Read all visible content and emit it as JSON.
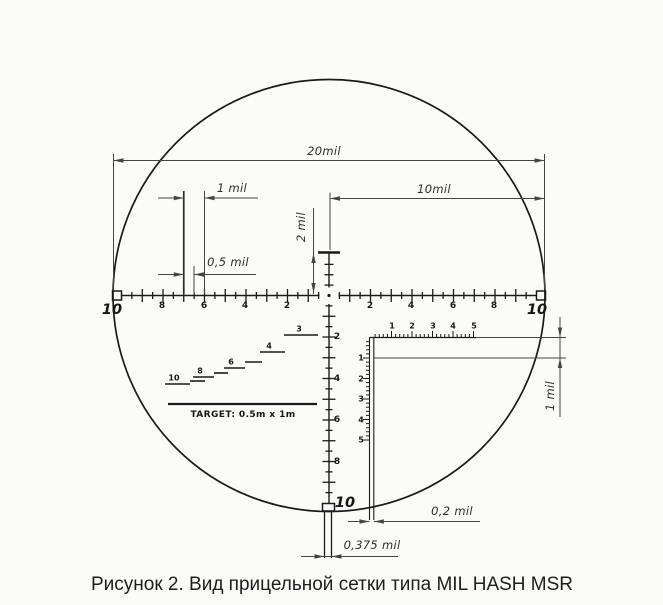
{
  "caption": "Рисунок 2. Вид прицельной сетки типа MIL HASH MSR",
  "reticle": {
    "h_left": [
      "8",
      "6",
      "4",
      "2"
    ],
    "h_right": [
      "2",
      "4",
      "6",
      "8"
    ],
    "v_down": [
      "2",
      "4",
      "6",
      "8"
    ],
    "edge_left": "10",
    "edge_right": "10",
    "edge_bottom": "10",
    "fine_h": [
      "1",
      "2",
      "3",
      "4",
      "5"
    ],
    "fine_v": [
      "1",
      "2",
      "3",
      "4",
      "5"
    ],
    "stairs": [
      "10",
      "8",
      "6",
      "4",
      "3"
    ],
    "target_label": "TARGET:  0.5m  x  1m"
  },
  "dims": {
    "d20": "20mil",
    "d10": "10mil",
    "d1_top": "1 mil",
    "d05": "0,5 mil",
    "d2": "2 mil",
    "d1_right": "1 mil",
    "d02": "0,2 mil",
    "d0375": "0,375 mil"
  },
  "colors": {
    "line": "#1a1a1a",
    "dim": "#454545",
    "bg": "#fbfbfa"
  }
}
